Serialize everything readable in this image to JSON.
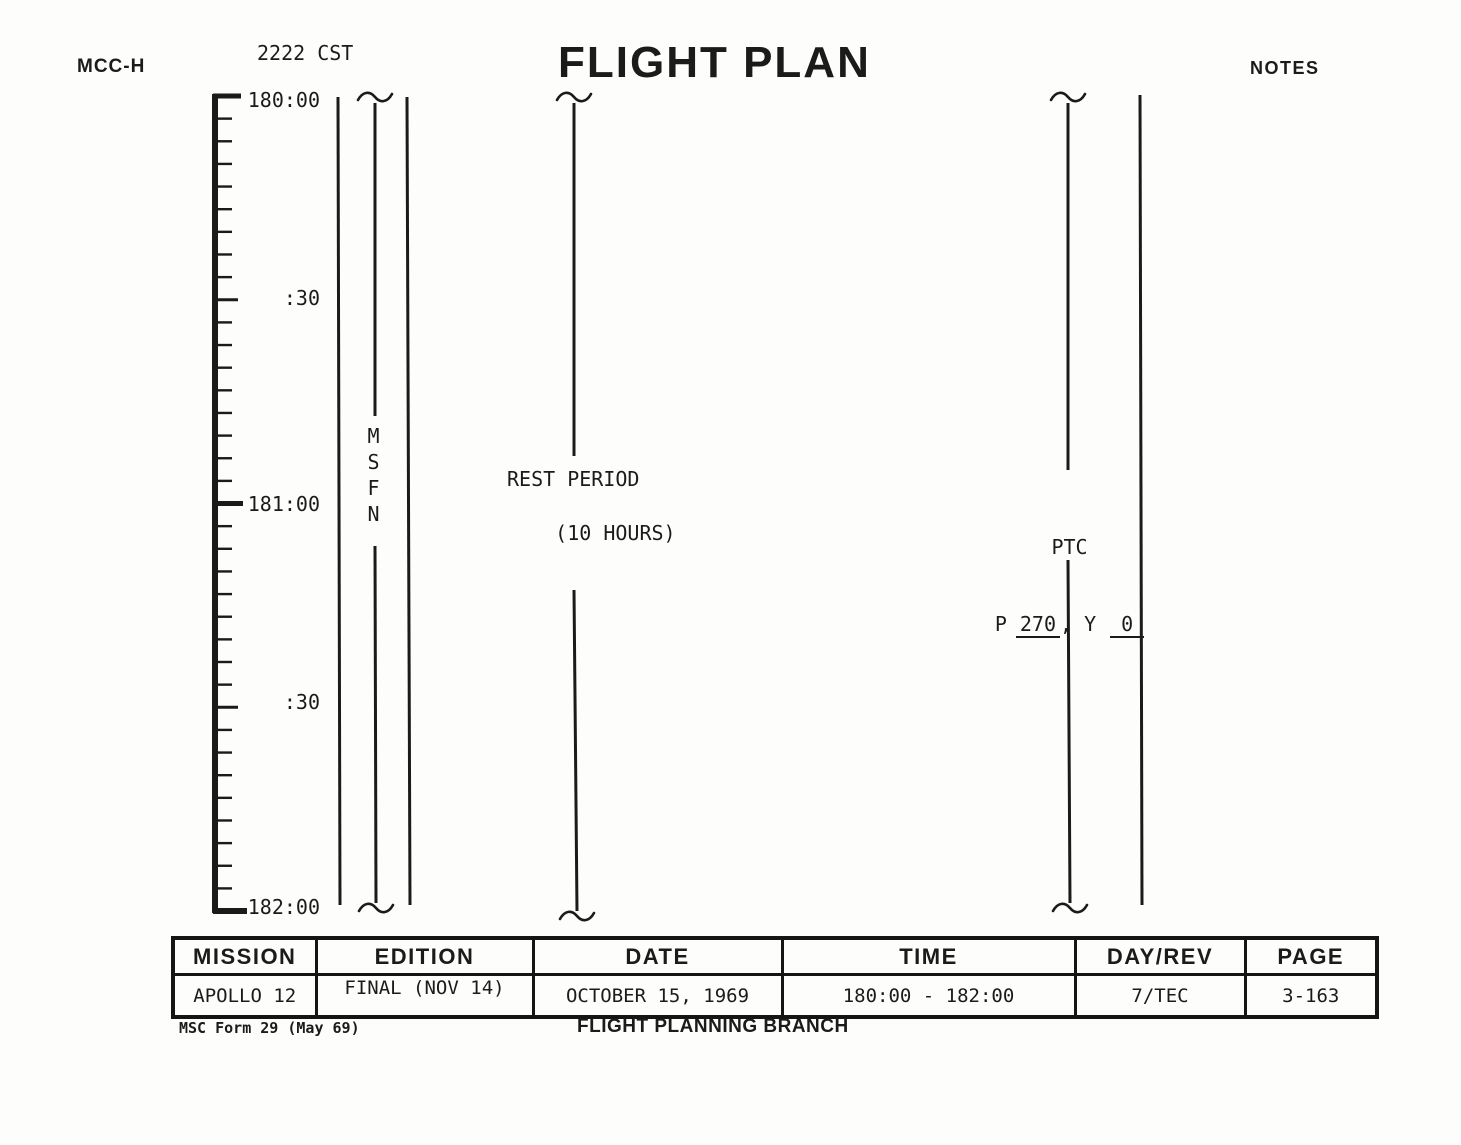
{
  "colors": {
    "ink": "#1b1b1b",
    "paper": "#fdfdfb"
  },
  "header": {
    "station": "MCC-H",
    "cst_time": "2222 CST",
    "title": "FLIGHT PLAN",
    "notes_label": "NOTES"
  },
  "timeline": {
    "labels": [
      "180:00",
      ":30",
      "181:00",
      ":30",
      "182:00"
    ]
  },
  "annotations": {
    "msfn": "MSFN",
    "rest_period_line1": "REST PERIOD",
    "rest_period_line2": "(10 HOURS)",
    "ptc_title": "PTC",
    "ptc_p_label": "P",
    "ptc_pitch": "270",
    "ptc_y_label": ", Y",
    "ptc_yaw": "0"
  },
  "footer_table": {
    "headers": [
      "MISSION",
      "EDITION",
      "DATE",
      "TIME",
      "DAY/REV",
      "PAGE"
    ],
    "values": [
      "APOLLO 12",
      "FINAL (NOV 14)",
      "OCTOBER 15, 1969",
      "180:00 - 182:00",
      "7/TEC",
      "3-163"
    ]
  },
  "footer": {
    "form_id": "MSC Form 29 (May 69)",
    "branch": "FLIGHT PLANNING BRANCH"
  }
}
